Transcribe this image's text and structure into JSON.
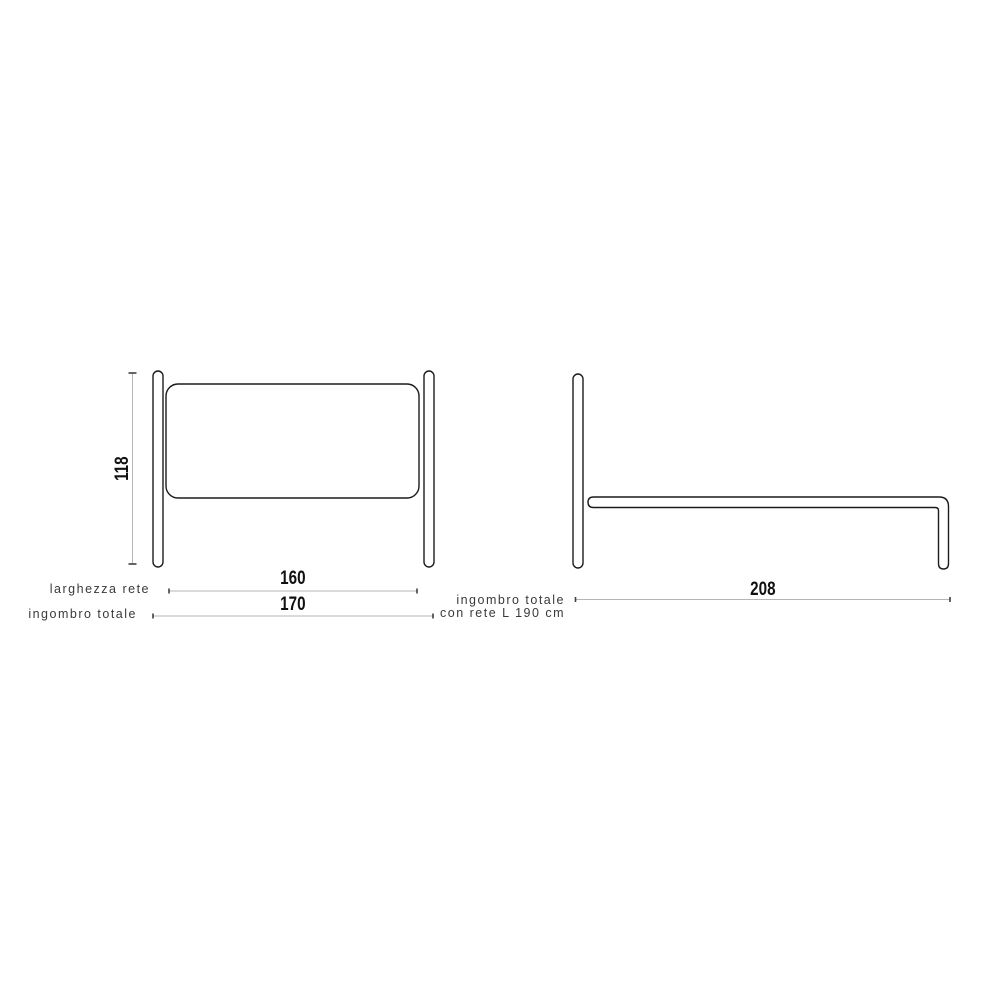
{
  "colors": {
    "background": "#ffffff",
    "outline": "#1c1c1c",
    "dimension_line": "#b5b5b5",
    "tick": "#404040",
    "number_text": "#111111",
    "label_text": "#3a3a3a"
  },
  "front_view": {
    "height_value": "118",
    "net_width": {
      "label": "larghezza rete",
      "value": "160"
    },
    "total_width": {
      "label": "ingombro totale",
      "value": "170"
    }
  },
  "side_view": {
    "total_length": {
      "label_line1": "ingombro totale",
      "label_line2": "con rete L 190 cm",
      "value": "208"
    }
  }
}
